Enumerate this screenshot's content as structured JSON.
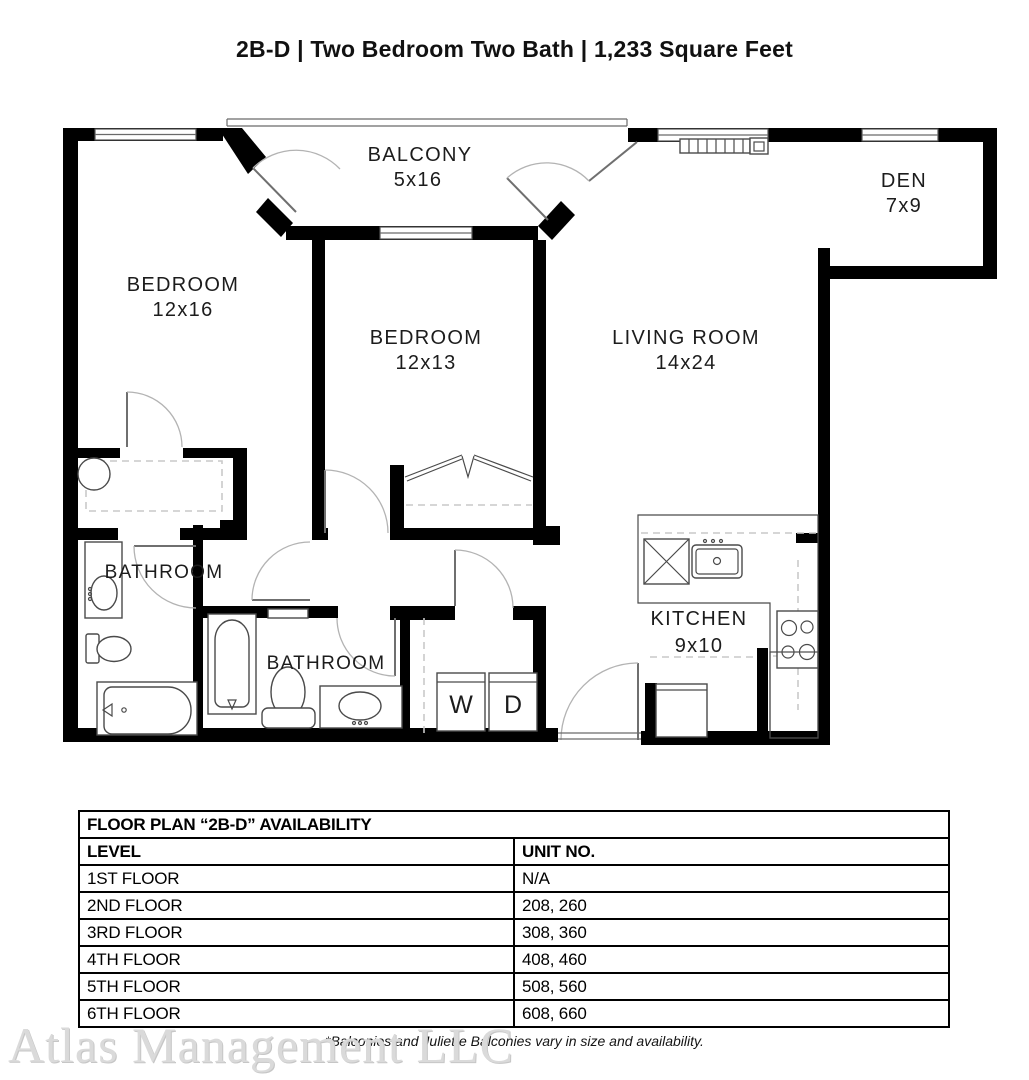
{
  "page": {
    "title": "2B-D | Two Bedroom Two Bath | 1,233 Square Feet"
  },
  "floor_plan": {
    "rooms": [
      {
        "id": "balcony",
        "name": "BALCONY",
        "dims": "5x16"
      },
      {
        "id": "den",
        "name": "DEN",
        "dims": "7x9"
      },
      {
        "id": "bedroom-1",
        "name": "BEDROOM",
        "dims": "12x16"
      },
      {
        "id": "bedroom-2",
        "name": "BEDROOM",
        "dims": "12x13"
      },
      {
        "id": "living-room",
        "name": "LIVING ROOM",
        "dims": "14x24"
      },
      {
        "id": "bathroom-1",
        "name": "BATHROOM",
        "dims": ""
      },
      {
        "id": "bathroom-2",
        "name": "BATHROOM",
        "dims": ""
      },
      {
        "id": "kitchen",
        "name": "KITCHEN",
        "dims": "9x10"
      }
    ],
    "appliances": {
      "washer_label": "W",
      "dryer_label": "D"
    }
  },
  "availability_table": {
    "title": "FLOOR PLAN “2B-D” AVAILABILITY",
    "columns": [
      "LEVEL",
      "UNIT NO."
    ],
    "rows": [
      [
        "1ST FLOOR",
        "N/A"
      ],
      [
        "2ND FLOOR",
        "208, 260"
      ],
      [
        "3RD FLOOR",
        "308, 360"
      ],
      [
        "4TH FLOOR",
        "408, 460"
      ],
      [
        "5TH FLOOR",
        "508, 560"
      ],
      [
        "6TH FLOOR",
        "608, 660"
      ]
    ]
  },
  "footnote": "*Balconies and Juliette Balconies vary in size and availability.",
  "watermark": "Atlas Management LLC",
  "colors": {
    "wall": "#000000",
    "label": "#1c1c1c",
    "dashed": "#c9c9c9",
    "watermark": "#dadada"
  }
}
